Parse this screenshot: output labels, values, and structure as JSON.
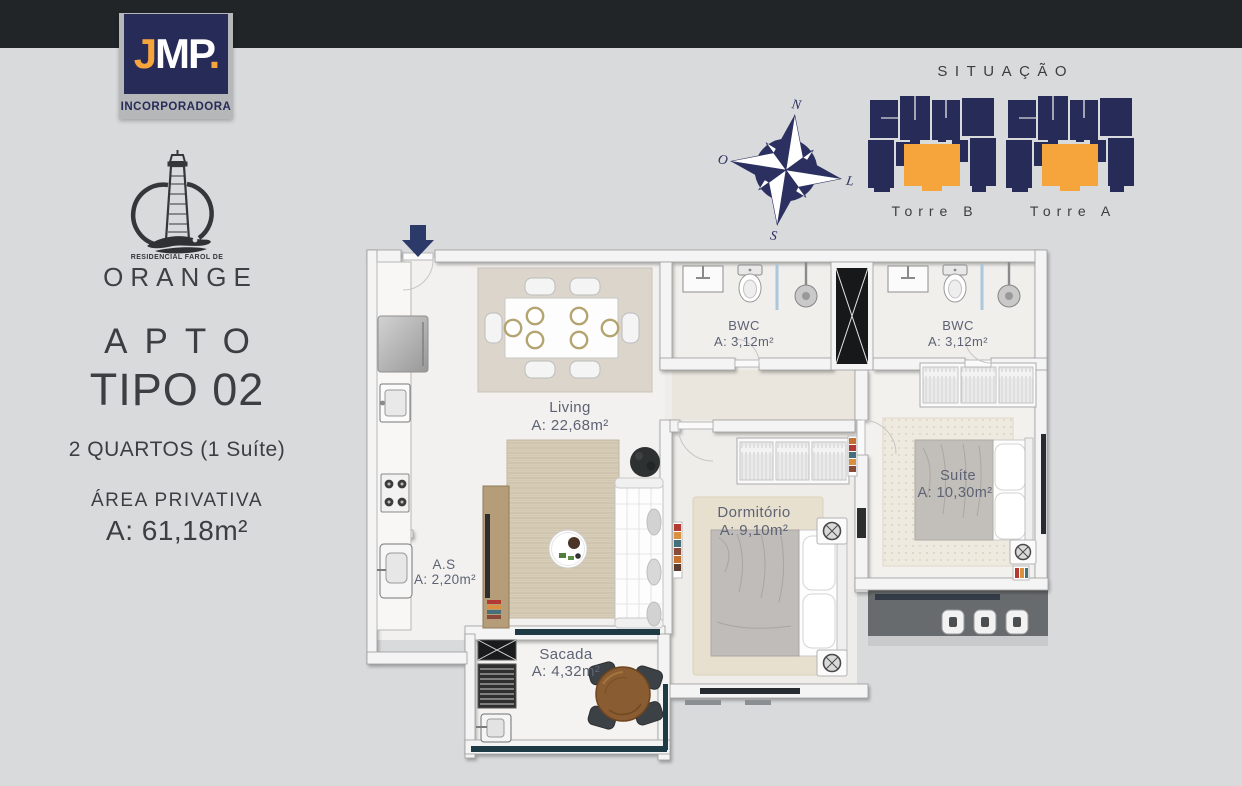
{
  "page": {
    "bg": "#d9dadc",
    "topbar_color": "#212528"
  },
  "jmp_logo": {
    "j": "J",
    "mp": "MP",
    "dot": ".",
    "subtitle": "INCORPORADORA",
    "navy": "#1c2355",
    "orange": "#f0a22e"
  },
  "residencial_logo": {
    "tagline": "RESIDENCIAL FAROL DE",
    "name": "ORANGE"
  },
  "left_panel": {
    "title_line1": "APTO",
    "title_line2": "TIPO 02",
    "subtitle": "2 QUARTOS (1 Suíte)",
    "area_label": "ÁREA PRIVATIVA",
    "area_value": "A: 61,18m²"
  },
  "situacao": {
    "title": "SITUAÇÃO",
    "towers": [
      {
        "label": "Torre B"
      },
      {
        "label": "Torre A"
      }
    ],
    "navy": "#272b58",
    "orange": "#f6a53c"
  },
  "compass": {
    "north": "N",
    "west": "O",
    "east": "L",
    "south": "S",
    "color": "#2b3060"
  },
  "floor_plan": {
    "entry_arrow_color": "#2b3a68",
    "label_color": "#5d6374",
    "railing_glass_color": "#1d3a45",
    "corridor_color": "#686b6e",
    "rooms": {
      "living": {
        "name": "Living",
        "area": "A: 22,68m²"
      },
      "bwc1": {
        "name": "BWC",
        "area": "A: 3,12m²"
      },
      "bwc2": {
        "name": "BWC",
        "area": "A: 3,12m²"
      },
      "dormitorio": {
        "name": "Dormitório",
        "area": "A: 9,10m²"
      },
      "suite": {
        "name": "Suíte",
        "area": "A: 10,30m²"
      },
      "servico": {
        "name": "A.S",
        "area": "A: 2,20m²"
      },
      "sacada": {
        "name": "Sacada",
        "area": "A: 4,32m²"
      }
    }
  }
}
